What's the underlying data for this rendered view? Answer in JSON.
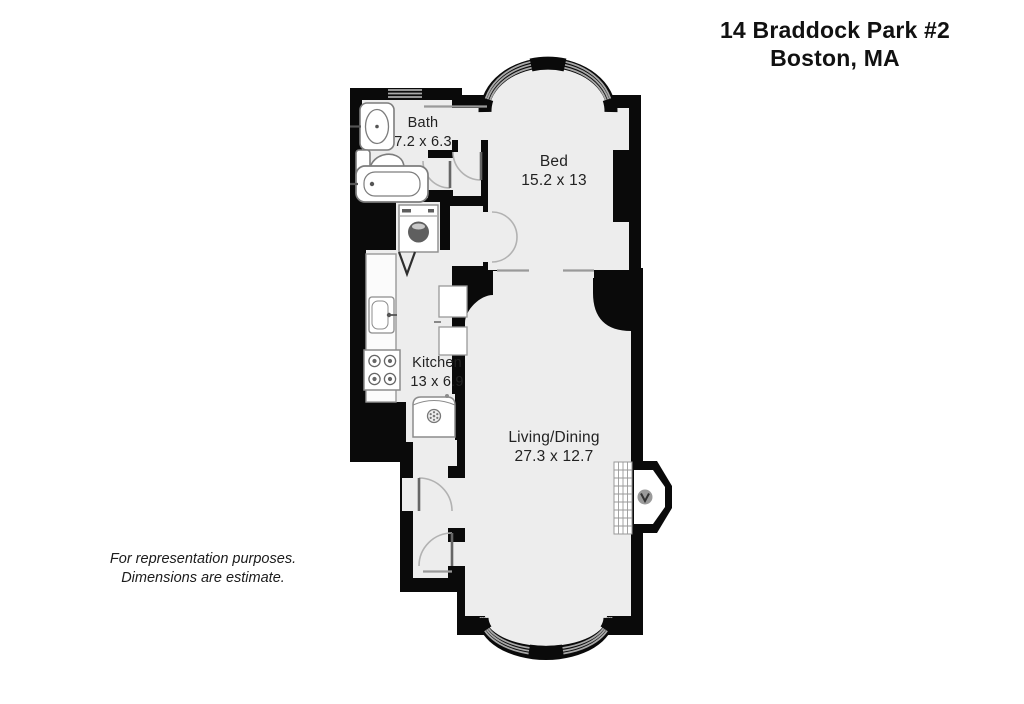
{
  "header": {
    "title_line1": "14 Braddock Park #2",
    "title_line2": "Boston, MA"
  },
  "rooms": {
    "bath": {
      "name": "Bath",
      "dimensions": "7.2 x 6.3"
    },
    "bed": {
      "name": "Bed",
      "dimensions": "15.2 x 13"
    },
    "kitchen": {
      "name": "Kitchen",
      "dimensions": "13 x 6.9"
    },
    "living_dining": {
      "name": "Living/Dining",
      "dimensions": "27.3 x 12.7"
    }
  },
  "footnote": {
    "line1": "For representation purposes.",
    "line2": "Dimensions are estimate."
  },
  "colors": {
    "wall": "#0a0a0a",
    "floor": "#ededed",
    "fixture_fill": "#ffffff",
    "fixture_outline": "#8c8c8c",
    "window_glazing": "#a8a8a8",
    "background": "#ffffff"
  },
  "icons": {
    "bathtub": "bathtub-icon",
    "toilet": "toilet-icon",
    "bath_sink": "sink-icon",
    "kitchen_sink": "kitchen-sink-icon",
    "stove": "stove-icon",
    "washer": "washer-icon",
    "refrigerator": "refrigerator-icon",
    "fireplace": "fireplace-icon",
    "closet_doors": "double-door-icon",
    "bay_window": "bay-window-icon"
  }
}
